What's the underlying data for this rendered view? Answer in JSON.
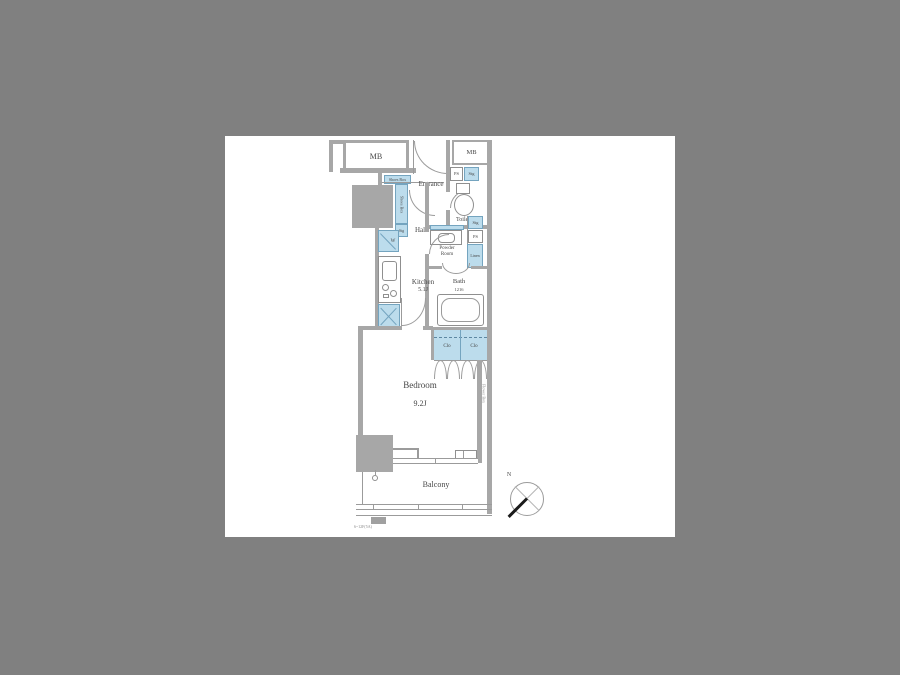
{
  "meta": {
    "background_color": "#808080",
    "canvas_color": "#ffffff",
    "wall_color": "#a7a7a7",
    "fixture_fill": "#bcdcec",
    "fixture_border": "#74a4bf",
    "text_color": "#474747"
  },
  "rooms": {
    "mb_left": "MB",
    "mb_right": "MB",
    "entrance": "Entrance",
    "hall": "Hall",
    "toilet": "Toilet",
    "kitchen": "Kitchen",
    "kitchen_size": "5.1J",
    "powder_line1": "Powder",
    "powder_line2": "Room",
    "bath": "Bath",
    "bath_size": "1216",
    "bedroom": "Bedroom",
    "bedroom_size": "9.2J",
    "balcony": "Balcony"
  },
  "fixtures": {
    "shoes_box_top": "Shoes Box",
    "shoes_box_side": "Shoes Box",
    "shoes_stg": "Stg",
    "ps_upper": "PS",
    "stg_upper": "Stg",
    "stg_toilet": "Stg",
    "ps_toilet": "PS",
    "washer": "W",
    "linen": "Linen",
    "closet_left": "Clo",
    "closet_right": "Clo",
    "flower_box": "Flower Box"
  },
  "compass": {
    "north": "N"
  },
  "footnote": "6~12F(5A)"
}
